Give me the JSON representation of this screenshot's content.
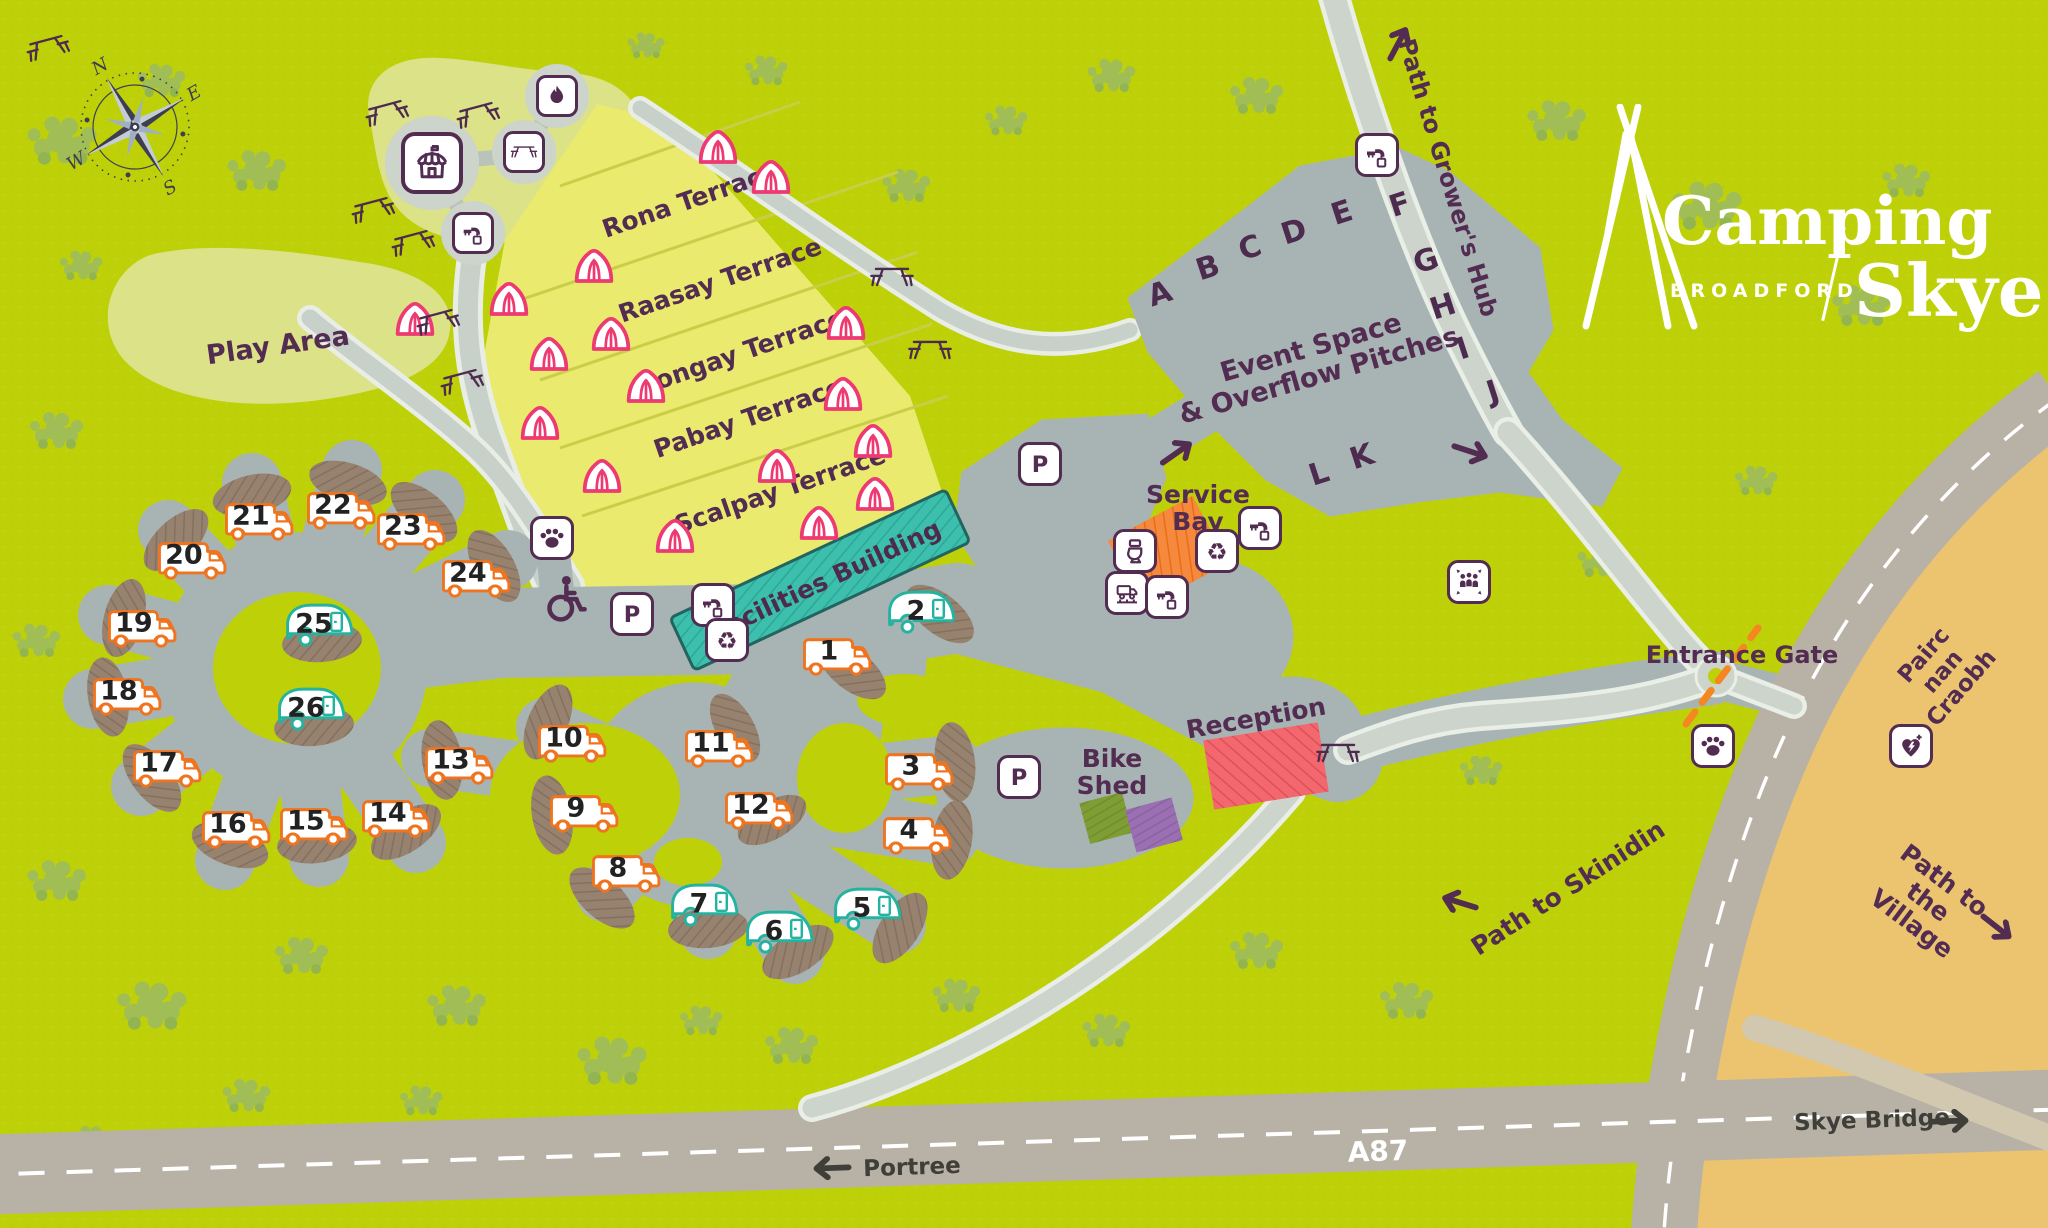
{
  "logo": {
    "word1": "Camping",
    "word2": "Skye",
    "subtitle": "BROADFORD"
  },
  "compass": {
    "n": "N",
    "e": "E",
    "s": "S",
    "w": "W"
  },
  "colors": {
    "background_green": "#bdd008",
    "tree_green": "#9abb66",
    "play_area": "#dce287",
    "terraces_yellow": "#e9ea6e",
    "hardstanding_grey": "#a8b4b4",
    "light_road": "#ccd4cc",
    "facilities_teal": "#3dbfae",
    "service_bay_orange": "#f58a3e",
    "reception_red": "#f2686e",
    "bike_shed_green": "#7e9d35",
    "bike_shed_purple": "#9a70b2",
    "sandy_area": "#ecc46f",
    "main_road_grey": "#b8b1a5",
    "label_plum": "#532c52",
    "pitch_motorhome_orange": "#ef7420",
    "pitch_caravan_teal": "#23b3a0",
    "tent_pink": "#ee3a72",
    "pad_brown": "#97826f",
    "entrance_gate_orange": "#f6861f",
    "plum": "#532c52"
  },
  "labels": [
    {
      "name": "play-area",
      "text": "Play Area",
      "x": 278,
      "y": 346,
      "rot": -8,
      "size": 27
    },
    {
      "name": "rona-terrace",
      "text": "Rona Terrace",
      "x": 690,
      "y": 200,
      "rot": -19,
      "size": 25
    },
    {
      "name": "raasay-terrace",
      "text": "Raasay Terrace",
      "x": 720,
      "y": 280,
      "rot": -19,
      "size": 25
    },
    {
      "name": "longay-terrace",
      "text": "Longay Terrace",
      "x": 742,
      "y": 352,
      "rot": -19,
      "size": 25
    },
    {
      "name": "pabay-terrace",
      "text": "Pabay Terrace",
      "x": 748,
      "y": 418,
      "rot": -19,
      "size": 25
    },
    {
      "name": "scalpay-terrace",
      "text": "Scalpay Terrace",
      "x": 780,
      "y": 490,
      "rot": -19,
      "size": 25
    },
    {
      "name": "facilities-building",
      "text": "Facilities Building",
      "x": 826,
      "y": 580,
      "rot": -25,
      "size": 25,
      "color": "#4c2b4e"
    },
    {
      "name": "event-space",
      "text": "Event Space\n& Overflow Pitches",
      "x": 1315,
      "y": 362,
      "rot": -16,
      "size": 27
    },
    {
      "name": "service-bay",
      "text": "Service\nBay",
      "x": 1198,
      "y": 508,
      "rot": 0,
      "size": 25
    },
    {
      "name": "reception",
      "text": "Reception",
      "x": 1256,
      "y": 718,
      "rot": -10,
      "size": 25
    },
    {
      "name": "bike-shed",
      "text": "Bike\nShed",
      "x": 1112,
      "y": 772,
      "rot": 0,
      "size": 25
    },
    {
      "name": "entrance-gate",
      "text": "Entrance Gate",
      "x": 1742,
      "y": 656,
      "rot": 0,
      "size": 24
    },
    {
      "name": "path-to-growers-hub",
      "text": "Path to Grower's Hub",
      "x": 1447,
      "y": 178,
      "rot": 73,
      "size": 24
    },
    {
      "name": "pairc-nan-craobh",
      "text": "Pairc nan Craobh",
      "x": 1943,
      "y": 672,
      "rot": -49,
      "size": 23
    },
    {
      "name": "path-to-skinidin",
      "text": "Path to Skinidin",
      "x": 1568,
      "y": 888,
      "rot": -33,
      "size": 25
    },
    {
      "name": "path-to-the-village",
      "text": "Path to the Village",
      "x": 1928,
      "y": 902,
      "rot": 37,
      "size": 25
    },
    {
      "name": "skye-bridge",
      "text": "Skye Bridge",
      "x": 1872,
      "y": 1121,
      "rot": -2,
      "size": 23,
      "color": "#3f3e39"
    },
    {
      "name": "a87",
      "text": "A87",
      "x": 1378,
      "y": 1152,
      "rot": -2,
      "size": 28,
      "color": "#ffffff"
    },
    {
      "name": "portree",
      "text": "Portree",
      "x": 912,
      "y": 1168,
      "rot": -2,
      "size": 23,
      "color": "#3f3e39"
    }
  ],
  "event_letters": [
    {
      "t": "A",
      "x": 1160,
      "y": 294
    },
    {
      "t": "B",
      "x": 1208,
      "y": 268
    },
    {
      "t": "C",
      "x": 1250,
      "y": 248
    },
    {
      "t": "D",
      "x": 1294,
      "y": 232
    },
    {
      "t": "E",
      "x": 1342,
      "y": 213
    },
    {
      "t": "F",
      "x": 1400,
      "y": 205
    },
    {
      "t": "G",
      "x": 1426,
      "y": 261
    },
    {
      "t": "H",
      "x": 1443,
      "y": 307
    },
    {
      "t": "I",
      "x": 1463,
      "y": 349
    },
    {
      "t": "J",
      "x": 1493,
      "y": 392
    },
    {
      "t": "K",
      "x": 1362,
      "y": 457
    },
    {
      "t": "L",
      "x": 1319,
      "y": 474
    }
  ],
  "pitches": [
    {
      "n": 1,
      "type": "motorhome",
      "x": 838,
      "y": 653
    },
    {
      "n": 2,
      "type": "caravan",
      "x": 922,
      "y": 610
    },
    {
      "n": 3,
      "type": "motorhome",
      "x": 920,
      "y": 768
    },
    {
      "n": 4,
      "type": "motorhome",
      "x": 918,
      "y": 832
    },
    {
      "n": 5,
      "type": "caravan",
      "x": 868,
      "y": 907
    },
    {
      "n": 6,
      "type": "caravan",
      "x": 780,
      "y": 930
    },
    {
      "n": 7,
      "type": "caravan",
      "x": 705,
      "y": 903
    },
    {
      "n": 8,
      "type": "motorhome",
      "x": 627,
      "y": 870
    },
    {
      "n": 9,
      "type": "motorhome",
      "x": 585,
      "y": 810
    },
    {
      "n": 10,
      "type": "motorhome",
      "x": 573,
      "y": 740
    },
    {
      "n": 11,
      "type": "motorhome",
      "x": 720,
      "y": 745
    },
    {
      "n": 12,
      "type": "motorhome",
      "x": 760,
      "y": 807
    },
    {
      "n": 13,
      "type": "motorhome",
      "x": 460,
      "y": 762
    },
    {
      "n": 14,
      "type": "motorhome",
      "x": 397,
      "y": 815
    },
    {
      "n": 15,
      "type": "motorhome",
      "x": 315,
      "y": 823
    },
    {
      "n": 16,
      "type": "motorhome",
      "x": 237,
      "y": 826
    },
    {
      "n": 17,
      "type": "motorhome",
      "x": 168,
      "y": 765
    },
    {
      "n": 18,
      "type": "motorhome",
      "x": 128,
      "y": 693
    },
    {
      "n": 19,
      "type": "motorhome",
      "x": 143,
      "y": 625
    },
    {
      "n": 20,
      "type": "motorhome",
      "x": 193,
      "y": 557
    },
    {
      "n": 21,
      "type": "motorhome",
      "x": 260,
      "y": 518
    },
    {
      "n": 22,
      "type": "motorhome",
      "x": 342,
      "y": 507
    },
    {
      "n": 23,
      "type": "motorhome",
      "x": 412,
      "y": 528
    },
    {
      "n": 24,
      "type": "motorhome",
      "x": 477,
      "y": 575
    },
    {
      "n": 25,
      "type": "caravan",
      "x": 320,
      "y": 623
    },
    {
      "n": 26,
      "type": "caravan",
      "x": 312,
      "y": 707
    }
  ],
  "icons": [
    {
      "name": "bigtop",
      "style": "circlelg",
      "x": 432,
      "y": 163
    },
    {
      "name": "picnic",
      "style": "circle",
      "x": 524,
      "y": 152
    },
    {
      "name": "fire",
      "style": "circle",
      "x": 557,
      "y": 96
    },
    {
      "name": "tap",
      "style": "circle",
      "x": 473,
      "y": 233
    },
    {
      "name": "paw",
      "style": "box",
      "x": 552,
      "y": 538
    },
    {
      "name": "wheelchair",
      "style": "plain",
      "x": 563,
      "y": 598
    },
    {
      "name": "parking",
      "style": "box",
      "x": 632,
      "y": 614
    },
    {
      "name": "tap",
      "style": "box",
      "x": 713,
      "y": 605
    },
    {
      "name": "recycle",
      "style": "box",
      "x": 727,
      "y": 640
    },
    {
      "name": "parking",
      "style": "box",
      "x": 1040,
      "y": 464
    },
    {
      "name": "tap",
      "style": "box",
      "x": 1377,
      "y": 155
    },
    {
      "name": "toilet",
      "style": "box",
      "x": 1135,
      "y": 551
    },
    {
      "name": "service",
      "style": "box",
      "x": 1127,
      "y": 593
    },
    {
      "name": "tap",
      "style": "box",
      "x": 1167,
      "y": 597
    },
    {
      "name": "recycle",
      "style": "box",
      "x": 1217,
      "y": 551
    },
    {
      "name": "tap",
      "style": "box",
      "x": 1260,
      "y": 528
    },
    {
      "name": "parking",
      "style": "box",
      "x": 1019,
      "y": 777
    },
    {
      "name": "assembly",
      "style": "box",
      "x": 1469,
      "y": 582
    },
    {
      "name": "paw",
      "style": "box",
      "x": 1713,
      "y": 746
    },
    {
      "name": "defib",
      "style": "box",
      "x": 1911,
      "y": 746
    }
  ],
  "tents": [
    {
      "x": 718,
      "y": 146
    },
    {
      "x": 771,
      "y": 176
    },
    {
      "x": 594,
      "y": 265
    },
    {
      "x": 509,
      "y": 298
    },
    {
      "x": 611,
      "y": 333
    },
    {
      "x": 549,
      "y": 353
    },
    {
      "x": 646,
      "y": 385
    },
    {
      "x": 846,
      "y": 322
    },
    {
      "x": 843,
      "y": 393
    },
    {
      "x": 873,
      "y": 440
    },
    {
      "x": 875,
      "y": 493
    },
    {
      "x": 777,
      "y": 465
    },
    {
      "x": 819,
      "y": 522
    },
    {
      "x": 675,
      "y": 535
    },
    {
      "x": 602,
      "y": 475
    },
    {
      "x": 415,
      "y": 318
    },
    {
      "x": 540,
      "y": 422
    }
  ],
  "picnic_tables": [
    {
      "x": 48,
      "y": 48,
      "rot": -15
    },
    {
      "x": 387,
      "y": 113,
      "rot": -15
    },
    {
      "x": 478,
      "y": 115,
      "rot": -15
    },
    {
      "x": 373,
      "y": 210,
      "rot": -15
    },
    {
      "x": 413,
      "y": 243,
      "rot": -15
    },
    {
      "x": 438,
      "y": 322,
      "rot": -15
    },
    {
      "x": 462,
      "y": 382,
      "rot": -15
    },
    {
      "x": 892,
      "y": 277,
      "rot": 0
    },
    {
      "x": 930,
      "y": 350,
      "rot": 0
    },
    {
      "x": 1338,
      "y": 753,
      "rot": 0
    }
  ],
  "arrows": [
    {
      "name": "growers-hub-arrow",
      "x": 1399,
      "y": 42,
      "rot": -62,
      "color": "#532c52"
    },
    {
      "name": "event-entry-arrow",
      "x": 1178,
      "y": 452,
      "rot": -35,
      "color": "#532c52"
    },
    {
      "name": "event-exit-arrow",
      "x": 1472,
      "y": 452,
      "rot": 18,
      "color": "#532c52"
    },
    {
      "name": "skinidin-arrow",
      "x": 1458,
      "y": 902,
      "rot": 197,
      "color": "#532c52"
    },
    {
      "name": "village-arrow",
      "x": 1998,
      "y": 928,
      "rot": 38,
      "color": "#532c52"
    },
    {
      "name": "skye-bridge-arrow",
      "x": 1952,
      "y": 1121,
      "rot": -2,
      "color": "#3f3e39"
    },
    {
      "name": "portree-arrow",
      "x": 830,
      "y": 1168,
      "rot": 178,
      "color": "#3f3e39"
    }
  ]
}
